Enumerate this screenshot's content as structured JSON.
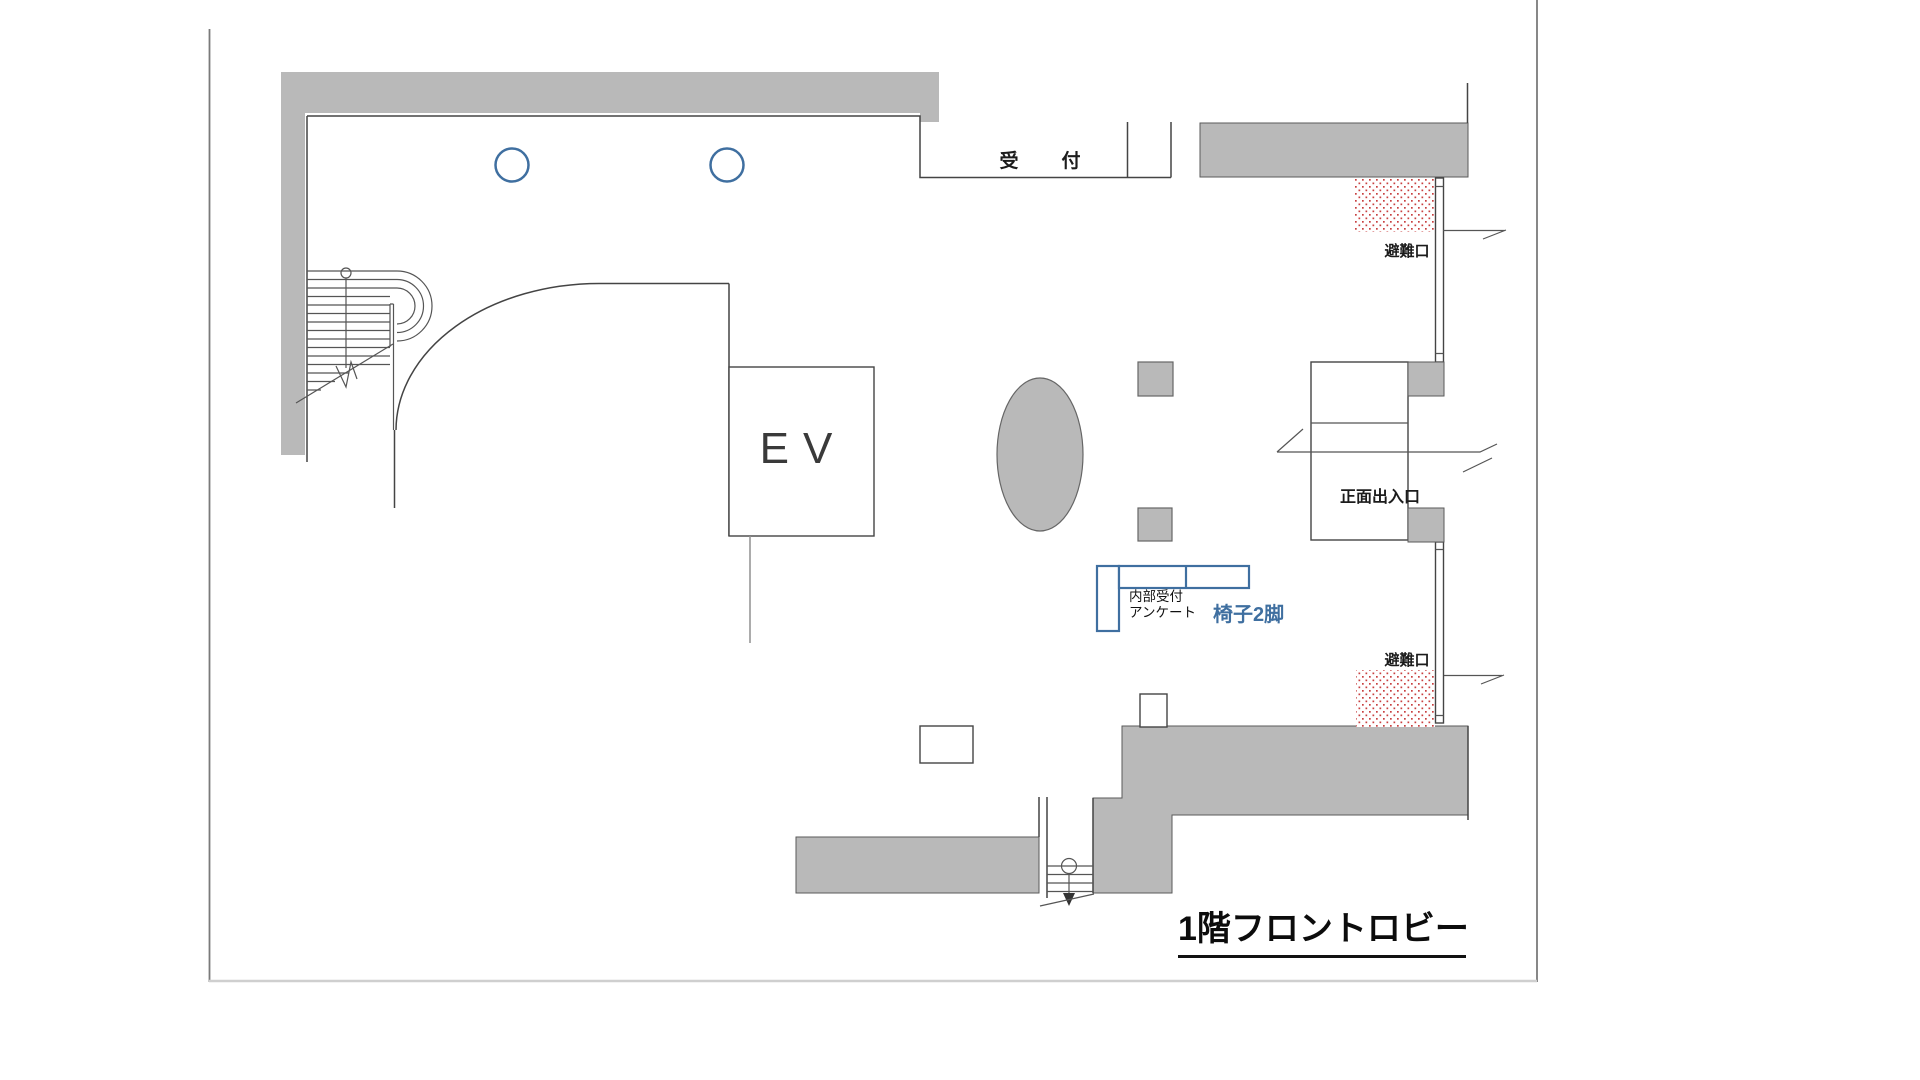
{
  "floor_plan": {
    "title": "1階フロントロビー",
    "labels": {
      "reception": "受　付",
      "emergency_exit_top": "避難口",
      "emergency_exit_bottom": "避難口",
      "main_entrance": "正面出入口",
      "elevator": "EV",
      "internal_desk_line1": "内部受付",
      "internal_desk_line2": "アンケート",
      "chairs_note": "椅子2脚"
    },
    "colors": {
      "wall_fill": "#b9b9b9",
      "line": "#444444",
      "accent_blue": "#3f6fa0",
      "hatch_red": "#c84040",
      "border": "#9a9a9a"
    }
  }
}
